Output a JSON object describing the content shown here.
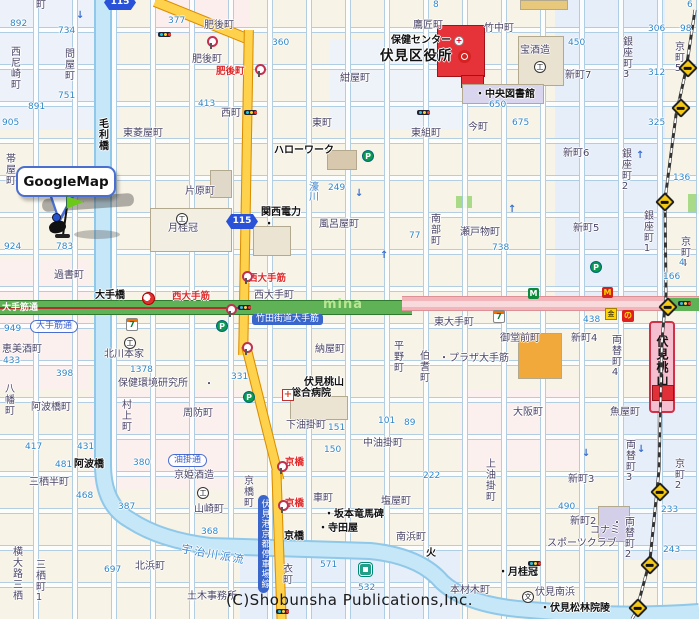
{
  "balloon": {
    "label": "GoogleMap"
  },
  "copyright": "(C)Shobunsha Publications,Inc.",
  "station": {
    "name": "伏見桃山駅"
  },
  "route_shields": [
    {
      "num": "115",
      "x": 104,
      "y": -5
    },
    {
      "num": "115",
      "x": 226,
      "y": 214
    }
  ],
  "colors": {
    "route_road": "#ffd24d",
    "otesuji_green": "#5fb356",
    "east_road_pink": "#f2b6ba",
    "river_blue": "#c6e7f7",
    "ward_office_red": "#e63239",
    "station_pink": "#f6bfcf",
    "balloon_border_blue": "#4a6fd0"
  },
  "labels": [
    {
      "s": "町",
      "x": 36,
      "y": 1,
      "c": "t"
    },
    {
      "s": "892",
      "x": 10,
      "y": 20,
      "c": "n"
    },
    {
      "s": "734",
      "x": 58,
      "y": 27,
      "c": "n"
    },
    {
      "s": "377",
      "x": 168,
      "y": 17,
      "c": "n"
    },
    {
      "s": "肥後町",
      "x": 204,
      "y": 21,
      "c": "t"
    },
    {
      "s": "肥後町",
      "x": 192,
      "y": 55,
      "c": "t"
    },
    {
      "s": "肥後町",
      "x": 216,
      "y": 67,
      "c": "r"
    },
    {
      "s": "西尼崎町",
      "x": 8,
      "y": 46,
      "c": "tv"
    },
    {
      "s": "問屋町",
      "x": 62,
      "y": 48,
      "c": "tv"
    },
    {
      "s": "751",
      "x": 58,
      "y": 92,
      "c": "n"
    },
    {
      "s": "891",
      "x": 28,
      "y": 103,
      "c": "n"
    },
    {
      "s": "905",
      "x": 2,
      "y": 119,
      "c": "n"
    },
    {
      "s": "413",
      "x": 198,
      "y": 100,
      "c": "n"
    },
    {
      "s": "西町",
      "x": 221,
      "y": 109,
      "c": "t"
    },
    {
      "s": "360",
      "x": 272,
      "y": 39,
      "c": "n"
    },
    {
      "s": "8",
      "x": 433,
      "y": 1,
      "c": "n"
    },
    {
      "s": "6",
      "x": 687,
      "y": 1,
      "c": "n"
    },
    {
      "s": "鷹匠町",
      "x": 413,
      "y": 21,
      "c": "t"
    },
    {
      "s": "保健センター",
      "x": 391,
      "y": 36,
      "c": "bb"
    },
    {
      "s": "伏見区役所",
      "x": 380,
      "y": 49,
      "c": "bigb"
    },
    {
      "s": "竹中町",
      "x": 484,
      "y": 24,
      "c": "t"
    },
    {
      "s": "宝酒造",
      "x": 520,
      "y": 46,
      "c": "t"
    },
    {
      "s": "・中央図書館",
      "x": 475,
      "y": 90,
      "c": "bb"
    },
    {
      "s": "紺屋町",
      "x": 340,
      "y": 74,
      "c": "t"
    },
    {
      "s": "新町7",
      "x": 565,
      "y": 71,
      "c": "t"
    },
    {
      "s": "銀座町3",
      "x": 620,
      "y": 36,
      "c": "tv"
    },
    {
      "s": "京町5",
      "x": 672,
      "y": 41,
      "c": "tv"
    },
    {
      "s": "306",
      "x": 648,
      "y": 25,
      "c": "n"
    },
    {
      "s": "98",
      "x": 680,
      "y": 25,
      "c": "n"
    },
    {
      "s": "450",
      "x": 568,
      "y": 39,
      "c": "n"
    },
    {
      "s": "312",
      "x": 648,
      "y": 69,
      "c": "n"
    },
    {
      "s": "650",
      "x": 489,
      "y": 101,
      "c": "n"
    },
    {
      "s": "675",
      "x": 512,
      "y": 119,
      "c": "n"
    },
    {
      "s": "325",
      "x": 648,
      "y": 119,
      "c": "n"
    },
    {
      "s": "今町",
      "x": 468,
      "y": 123,
      "c": "t"
    },
    {
      "s": "東町",
      "x": 312,
      "y": 119,
      "c": "t"
    },
    {
      "s": "東組町",
      "x": 411,
      "y": 129,
      "c": "t"
    },
    {
      "s": "毛利橋",
      "x": 96,
      "y": 118,
      "c": "tvb"
    },
    {
      "s": "東菱屋町",
      "x": 123,
      "y": 129,
      "c": "t"
    },
    {
      "s": "帯屋町",
      "x": 3,
      "y": 153,
      "c": "tv"
    },
    {
      "s": "片原町",
      "x": 185,
      "y": 187,
      "c": "t"
    },
    {
      "s": "月桂冠",
      "x": 168,
      "y": 224,
      "c": "t"
    },
    {
      "s": "ハローワーク",
      "x": 274,
      "y": 146,
      "c": "bb"
    },
    {
      "s": "関西電力",
      "x": 261,
      "y": 208,
      "c": "bb"
    },
    {
      "s": "・",
      "x": 264,
      "y": 220,
      "c": "bb"
    },
    {
      "s": "風呂屋町",
      "x": 319,
      "y": 220,
      "c": "t"
    },
    {
      "s": "南部町",
      "x": 428,
      "y": 213,
      "c": "tv"
    },
    {
      "s": "瀬戸物町",
      "x": 460,
      "y": 228,
      "c": "t"
    },
    {
      "s": "738",
      "x": 492,
      "y": 244,
      "c": "n"
    },
    {
      "s": "249",
      "x": 328,
      "y": 184,
      "c": "n"
    },
    {
      "s": "77",
      "x": 409,
      "y": 232,
      "c": "n"
    },
    {
      "s": "新町6",
      "x": 563,
      "y": 149,
      "c": "t"
    },
    {
      "s": "銀座町2",
      "x": 619,
      "y": 148,
      "c": "tv"
    },
    {
      "s": "新町5",
      "x": 573,
      "y": 224,
      "c": "t"
    },
    {
      "s": "銀座町1",
      "x": 641,
      "y": 210,
      "c": "tv"
    },
    {
      "s": "京町4",
      "x": 678,
      "y": 236,
      "c": "tv"
    },
    {
      "s": "136",
      "x": 673,
      "y": 174,
      "c": "n"
    },
    {
      "s": "濠川",
      "x": 306,
      "y": 181,
      "c": "bv"
    },
    {
      "s": "924",
      "x": 4,
      "y": 243,
      "c": "n"
    },
    {
      "s": "783",
      "x": 56,
      "y": 243,
      "c": "n"
    },
    {
      "s": "過書町",
      "x": 54,
      "y": 271,
      "c": "t"
    },
    {
      "s": "大手橋",
      "x": 95,
      "y": 291,
      "c": "bb"
    },
    {
      "s": "西大手筋",
      "x": 172,
      "y": 292,
      "c": "r"
    },
    {
      "s": "西大手筋",
      "x": 248,
      "y": 274,
      "c": "r"
    },
    {
      "s": "大手筋通",
      "x": 30,
      "y": 320,
      "c": "oval"
    },
    {
      "s": "大手筋通",
      "x": 2,
      "y": 304,
      "c": "w"
    },
    {
      "s": "949",
      "x": 4,
      "y": 325,
      "c": "n"
    },
    {
      "s": "433",
      "x": 3,
      "y": 357,
      "c": "n"
    },
    {
      "s": "恵美酒町",
      "x": 2,
      "y": 345,
      "c": "t"
    },
    {
      "s": "398",
      "x": 56,
      "y": 370,
      "c": "n"
    },
    {
      "s": "八幡町",
      "x": 2,
      "y": 383,
      "c": "tv"
    },
    {
      "s": "北川本家",
      "x": 104,
      "y": 350,
      "c": "t"
    },
    {
      "s": "1378",
      "x": 130,
      "y": 366,
      "c": "n"
    },
    {
      "s": "保健環境研究所",
      "x": 118,
      "y": 379,
      "c": "t"
    },
    {
      "s": "・",
      "x": 204,
      "y": 380,
      "c": "t"
    },
    {
      "s": "西大手町",
      "x": 254,
      "y": 291,
      "c": "t"
    },
    {
      "s": "竹田街道大手筋",
      "x": 252,
      "y": 314,
      "c": "bluebox"
    },
    {
      "s": "mina",
      "x": 323,
      "y": 298,
      "c": "wm"
    },
    {
      "s": "納屋町",
      "x": 315,
      "y": 345,
      "c": "t"
    },
    {
      "s": "平野町",
      "x": 391,
      "y": 340,
      "c": "tv"
    },
    {
      "s": "伯耆町",
      "x": 417,
      "y": 350,
      "c": "tv"
    },
    {
      "s": "東大手町",
      "x": 434,
      "y": 318,
      "c": "t"
    },
    {
      "s": "・プラザ大手筋",
      "x": 439,
      "y": 354,
      "c": "t"
    },
    {
      "s": "御堂前町",
      "x": 500,
      "y": 334,
      "c": "t"
    },
    {
      "s": "新町4",
      "x": 571,
      "y": 334,
      "c": "t"
    },
    {
      "s": "両替町4",
      "x": 609,
      "y": 334,
      "c": "tv"
    },
    {
      "s": "438",
      "x": 583,
      "y": 316,
      "c": "n"
    },
    {
      "s": "166",
      "x": 663,
      "y": 273,
      "c": "n"
    },
    {
      "s": "4",
      "x": 679,
      "y": 259,
      "c": "n"
    },
    {
      "s": "331",
      "x": 231,
      "y": 373,
      "c": "n"
    },
    {
      "s": "伏見桃山",
      "x": 304,
      "y": 378,
      "c": "bb"
    },
    {
      "s": "総合病院",
      "x": 291,
      "y": 389,
      "c": "bb"
    },
    {
      "s": "下油掛町",
      "x": 286,
      "y": 421,
      "c": "t"
    },
    {
      "s": "151",
      "x": 328,
      "y": 424,
      "c": "n"
    },
    {
      "s": "中油掛町",
      "x": 363,
      "y": 439,
      "c": "t"
    },
    {
      "s": "150",
      "x": 324,
      "y": 446,
      "c": "n"
    },
    {
      "s": "101",
      "x": 378,
      "y": 417,
      "c": "n"
    },
    {
      "s": "89",
      "x": 404,
      "y": 419,
      "c": "n"
    },
    {
      "s": "大阪町",
      "x": 513,
      "y": 408,
      "c": "t"
    },
    {
      "s": "魚屋町",
      "x": 610,
      "y": 408,
      "c": "t"
    },
    {
      "s": "両替町3",
      "x": 623,
      "y": 439,
      "c": "tv"
    },
    {
      "s": "新町3",
      "x": 568,
      "y": 475,
      "c": "t"
    },
    {
      "s": "上油掛町",
      "x": 483,
      "y": 458,
      "c": "tv"
    },
    {
      "s": "京町2",
      "x": 672,
      "y": 458,
      "c": "tv"
    },
    {
      "s": "233",
      "x": 661,
      "y": 506,
      "c": "n"
    },
    {
      "s": "490",
      "x": 558,
      "y": 503,
      "c": "n"
    },
    {
      "s": "222",
      "x": 423,
      "y": 472,
      "c": "n"
    },
    {
      "s": "阿波橋町",
      "x": 31,
      "y": 403,
      "c": "t"
    },
    {
      "s": "村上町",
      "x": 119,
      "y": 399,
      "c": "tv"
    },
    {
      "s": "周防町",
      "x": 183,
      "y": 409,
      "c": "t"
    },
    {
      "s": "417",
      "x": 25,
      "y": 443,
      "c": "n"
    },
    {
      "s": "431",
      "x": 77,
      "y": 443,
      "c": "n"
    },
    {
      "s": "481",
      "x": 55,
      "y": 461,
      "c": "n"
    },
    {
      "s": "380",
      "x": 133,
      "y": 459,
      "c": "n"
    },
    {
      "s": "阿波橋",
      "x": 74,
      "y": 460,
      "c": "bb"
    },
    {
      "s": "三栖半町",
      "x": 29,
      "y": 478,
      "c": "t"
    },
    {
      "s": "油掛通",
      "x": 168,
      "y": 454,
      "c": "oval"
    },
    {
      "s": "京姫酒造",
      "x": 174,
      "y": 471,
      "c": "t"
    },
    {
      "s": "山崎町",
      "x": 194,
      "y": 505,
      "c": "t"
    },
    {
      "s": "387",
      "x": 118,
      "y": 503,
      "c": "n"
    },
    {
      "s": "468",
      "x": 76,
      "y": 492,
      "c": "n"
    },
    {
      "s": "京橋",
      "x": 285,
      "y": 458,
      "c": "r"
    },
    {
      "s": "京橋",
      "x": 285,
      "y": 499,
      "c": "r"
    },
    {
      "s": "京橋町",
      "x": 241,
      "y": 475,
      "c": "tv"
    },
    {
      "s": "伏見港京都停車場線",
      "x": 258,
      "y": 495,
      "c": "vbluebox"
    },
    {
      "s": "車町",
      "x": 313,
      "y": 494,
      "c": "t"
    },
    {
      "s": "塩屋町",
      "x": 381,
      "y": 497,
      "c": "t"
    },
    {
      "s": "・坂本竜馬碑",
      "x": 324,
      "y": 510,
      "c": "bb"
    },
    {
      "s": "・寺田屋",
      "x": 318,
      "y": 524,
      "c": "bb"
    },
    {
      "s": "京橋",
      "x": 284,
      "y": 532,
      "c": "bb"
    },
    {
      "s": "南浜町",
      "x": 396,
      "y": 533,
      "c": "t"
    },
    {
      "s": "火",
      "x": 426,
      "y": 549,
      "c": "bb"
    },
    {
      "s": "衣町",
      "x": 280,
      "y": 563,
      "c": "tv"
    },
    {
      "s": "571",
      "x": 320,
      "y": 561,
      "c": "n"
    },
    {
      "s": "532",
      "x": 358,
      "y": 584,
      "c": "n"
    },
    {
      "s": "宇治川派流",
      "x": 181,
      "y": 549,
      "c": "briver"
    },
    {
      "s": "北浜町",
      "x": 135,
      "y": 562,
      "c": "t"
    },
    {
      "s": "697",
      "x": 104,
      "y": 566,
      "c": "n"
    },
    {
      "s": "368",
      "x": 201,
      "y": 528,
      "c": "n"
    },
    {
      "s": "土木事務所",
      "x": 187,
      "y": 592,
      "c": "t"
    },
    {
      "s": "三栖町1",
      "x": 33,
      "y": 559,
      "c": "tv"
    },
    {
      "s": "横大路三栖",
      "x": 10,
      "y": 546,
      "c": "tv"
    },
    {
      "s": "新町2",
      "x": 570,
      "y": 517,
      "c": "t"
    },
    {
      "s": "・",
      "x": 612,
      "y": 519,
      "c": "t"
    },
    {
      "s": "コナミ",
      "x": 590,
      "y": 526,
      "c": "t"
    },
    {
      "s": "スポーツクラブ",
      "x": 547,
      "y": 539,
      "c": "t"
    },
    {
      "s": "両替町2",
      "x": 622,
      "y": 516,
      "c": "tv"
    },
    {
      "s": "243",
      "x": 663,
      "y": 546,
      "c": "n"
    },
    {
      "s": "・月桂冠",
      "x": 498,
      "y": 568,
      "c": "bb"
    },
    {
      "s": "本材木町",
      "x": 450,
      "y": 586,
      "c": "t"
    },
    {
      "s": "伏見南浜",
      "x": 535,
      "y": 588,
      "c": "t"
    },
    {
      "s": "・伏見松林院陵",
      "x": 540,
      "y": 604,
      "c": "bb"
    }
  ],
  "icons": [
    {
      "k": "711",
      "x": 126,
      "y": 318
    },
    {
      "k": "711",
      "x": 493,
      "y": 310
    },
    {
      "k": "mcd",
      "x": 602,
      "y": 287
    },
    {
      "k": "bankm",
      "x": 528,
      "y": 288
    },
    {
      "k": "park",
      "x": 362,
      "y": 150
    },
    {
      "k": "park",
      "x": 216,
      "y": 320
    },
    {
      "k": "park",
      "x": 243,
      "y": 391
    },
    {
      "k": "park",
      "x": 590,
      "y": 261
    },
    {
      "k": "bus",
      "x": 206,
      "y": 36
    },
    {
      "k": "bus",
      "x": 254,
      "y": 64
    },
    {
      "k": "bus",
      "x": 276,
      "y": 461
    },
    {
      "k": "bus",
      "x": 277,
      "y": 500
    },
    {
      "k": "bus",
      "x": 241,
      "y": 342
    },
    {
      "k": "bus",
      "x": 225,
      "y": 304
    },
    {
      "k": "bus",
      "x": 241,
      "y": 271
    },
    {
      "k": "light",
      "x": 158,
      "y": 32
    },
    {
      "k": "light",
      "x": 244,
      "y": 110
    },
    {
      "k": "light",
      "x": 417,
      "y": 110
    },
    {
      "k": "light",
      "x": 238,
      "y": 305
    },
    {
      "k": "light",
      "x": 678,
      "y": 301
    },
    {
      "k": "light",
      "x": 276,
      "y": 609
    },
    {
      "k": "light",
      "x": 528,
      "y": 561
    },
    {
      "k": "cross",
      "x": 681,
      "y": 61
    },
    {
      "k": "cross",
      "x": 674,
      "y": 101
    },
    {
      "k": "cross",
      "x": 658,
      "y": 195
    },
    {
      "k": "cross",
      "x": 661,
      "y": 300
    },
    {
      "k": "cross",
      "x": 653,
      "y": 485
    },
    {
      "k": "cross",
      "x": 643,
      "y": 558
    },
    {
      "k": "cross",
      "x": 631,
      "y": 601
    },
    {
      "k": "govt",
      "x": 458,
      "y": 50
    },
    {
      "k": "health",
      "x": 454,
      "y": 36
    },
    {
      "k": "comp",
      "x": 534,
      "y": 61
    },
    {
      "k": "comp",
      "x": 176,
      "y": 213
    },
    {
      "k": "comp",
      "x": 124,
      "y": 337
    },
    {
      "k": "comp",
      "x": 197,
      "y": 487
    },
    {
      "k": "hosp",
      "x": 282,
      "y": 389
    },
    {
      "k": "school",
      "x": 522,
      "y": 591
    },
    {
      "k": "shopy",
      "x": 605,
      "y": 308
    },
    {
      "k": "shopr",
      "x": 622,
      "y": 310
    },
    {
      "k": "bridge",
      "x": 142,
      "y": 292
    },
    {
      "k": "gbank",
      "x": 359,
      "y": 563
    }
  ],
  "arrows": [
    {
      "g": "↓",
      "x": 76,
      "y": 10
    },
    {
      "g": "↓",
      "x": 355,
      "y": 188
    },
    {
      "g": "↑",
      "x": 636,
      "y": 150
    },
    {
      "g": "↑",
      "x": 508,
      "y": 204
    },
    {
      "g": "↓",
      "x": 582,
      "y": 448
    },
    {
      "g": "↓",
      "x": 637,
      "y": 444
    },
    {
      "g": "↑",
      "x": 380,
      "y": 250
    }
  ]
}
